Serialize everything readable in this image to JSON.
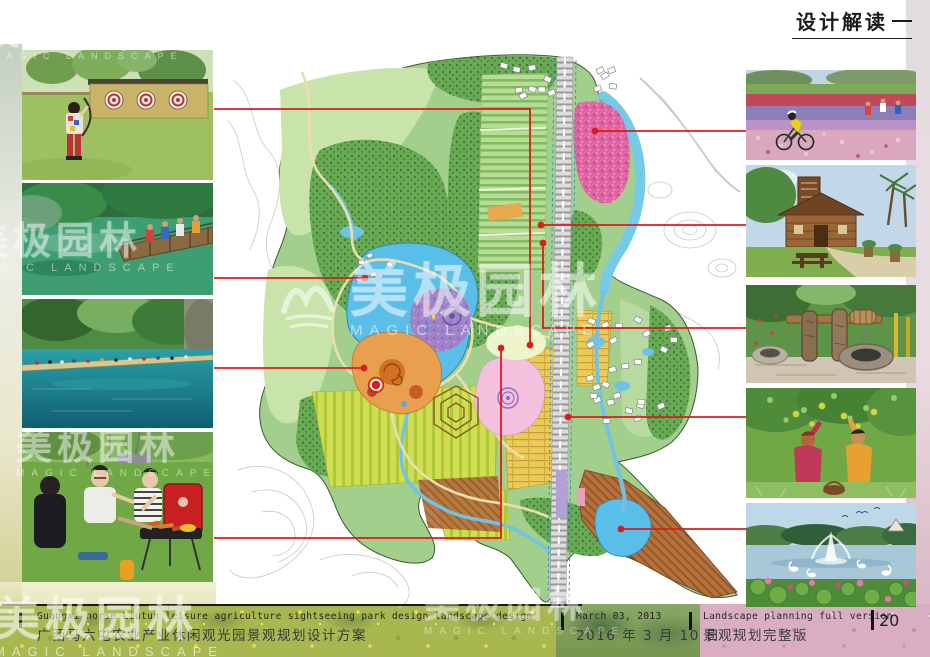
{
  "header": {
    "title": "设计解读"
  },
  "watermark": {
    "cn": "美极园林",
    "en": "MAGIC LANDSCAPE"
  },
  "footer": {
    "project_en": "Guangxi horse Liutun leisure agriculture sightseeing park design landscape design",
    "project_cn": "广西马六屯农业产业休闲观光园景观规划设计方案",
    "date_en": "March 03, 2013",
    "date_cn": "2016 年 3 月 10 日",
    "version_en": "Landscape planning full version",
    "version_cn": "景观规划完整版",
    "page_number": "20"
  },
  "photos": {
    "left": [
      {
        "id": "archery-range",
        "label": "child archery experience lawn with straw target wall"
      },
      {
        "id": "forest-boardwalk",
        "label": "wooden boardwalk bridge over emerald forest water"
      },
      {
        "id": "turquoise-lake",
        "label": "crowded lakeside boardwalk along turquoise lake"
      },
      {
        "id": "bbq-picnic",
        "label": "friends grilling at red barbecue on lawn"
      }
    ],
    "right": [
      {
        "id": "flower-field-cycling",
        "label": "cyclists riding through colorful flower fields"
      },
      {
        "id": "wooden-cabin",
        "label": "rustic wooden cabin lodge with palms and picnic table"
      },
      {
        "id": "old-water-well",
        "label": "old stone water well with wooden windlass"
      },
      {
        "id": "fruit-picking",
        "label": "two women picking fruit under orchard tree"
      },
      {
        "id": "swan-lake-fountain",
        "label": "lake with fountain, swans and lotus flowers"
      }
    ]
  },
  "map": {
    "colors": {
      "connector": "#dd1b1b",
      "park_green": "#a3cf8c",
      "lake_blue": "#59bee8",
      "flower_pink": "#e066a8",
      "zone_purple": "#a083c8",
      "zone_orange": "#e9a04e",
      "farm_yellow": "#ebcb58",
      "orchard_brown": "#b5713c"
    },
    "connectors": [
      {
        "id": "archery-range",
        "points": [
          [
            214,
            109
          ],
          [
            530,
            109
          ],
          [
            530,
            345
          ]
        ],
        "dot": [
          530,
          345
        ]
      },
      {
        "id": "forest-boardwalk",
        "points": [
          [
            214,
            278
          ],
          [
            365,
            278
          ]
        ],
        "dot": [
          365,
          278
        ]
      },
      {
        "id": "turquoise-lake",
        "points": [
          [
            214,
            368
          ],
          [
            364,
            368
          ]
        ],
        "dot": [
          364,
          368
        ]
      },
      {
        "id": "bbq-picnic",
        "points": [
          [
            214,
            538
          ],
          [
            501,
            538
          ],
          [
            501,
            348
          ]
        ],
        "dot": [
          501,
          348
        ]
      },
      {
        "id": "flower-field-cycling",
        "points": [
          [
            746,
            131
          ],
          [
            595,
            131
          ]
        ],
        "dot": [
          595,
          131
        ]
      },
      {
        "id": "wooden-cabin",
        "points": [
          [
            746,
            225
          ],
          [
            541,
            225
          ]
        ],
        "dot": [
          541,
          225
        ]
      },
      {
        "id": "old-water-well",
        "points": [
          [
            746,
            328
          ],
          [
            543,
            328
          ],
          [
            543,
            243
          ]
        ],
        "dot": [
          543,
          243
        ]
      },
      {
        "id": "fruit-picking",
        "points": [
          [
            746,
            417
          ],
          [
            568,
            417
          ]
        ],
        "dot": [
          568,
          417
        ]
      },
      {
        "id": "swan-lake-fountain",
        "points": [
          [
            746,
            529
          ],
          [
            621,
            529
          ]
        ],
        "dot": [
          621,
          529
        ]
      }
    ],
    "poi_marker": {
      "xy": [
        376,
        385
      ]
    }
  }
}
